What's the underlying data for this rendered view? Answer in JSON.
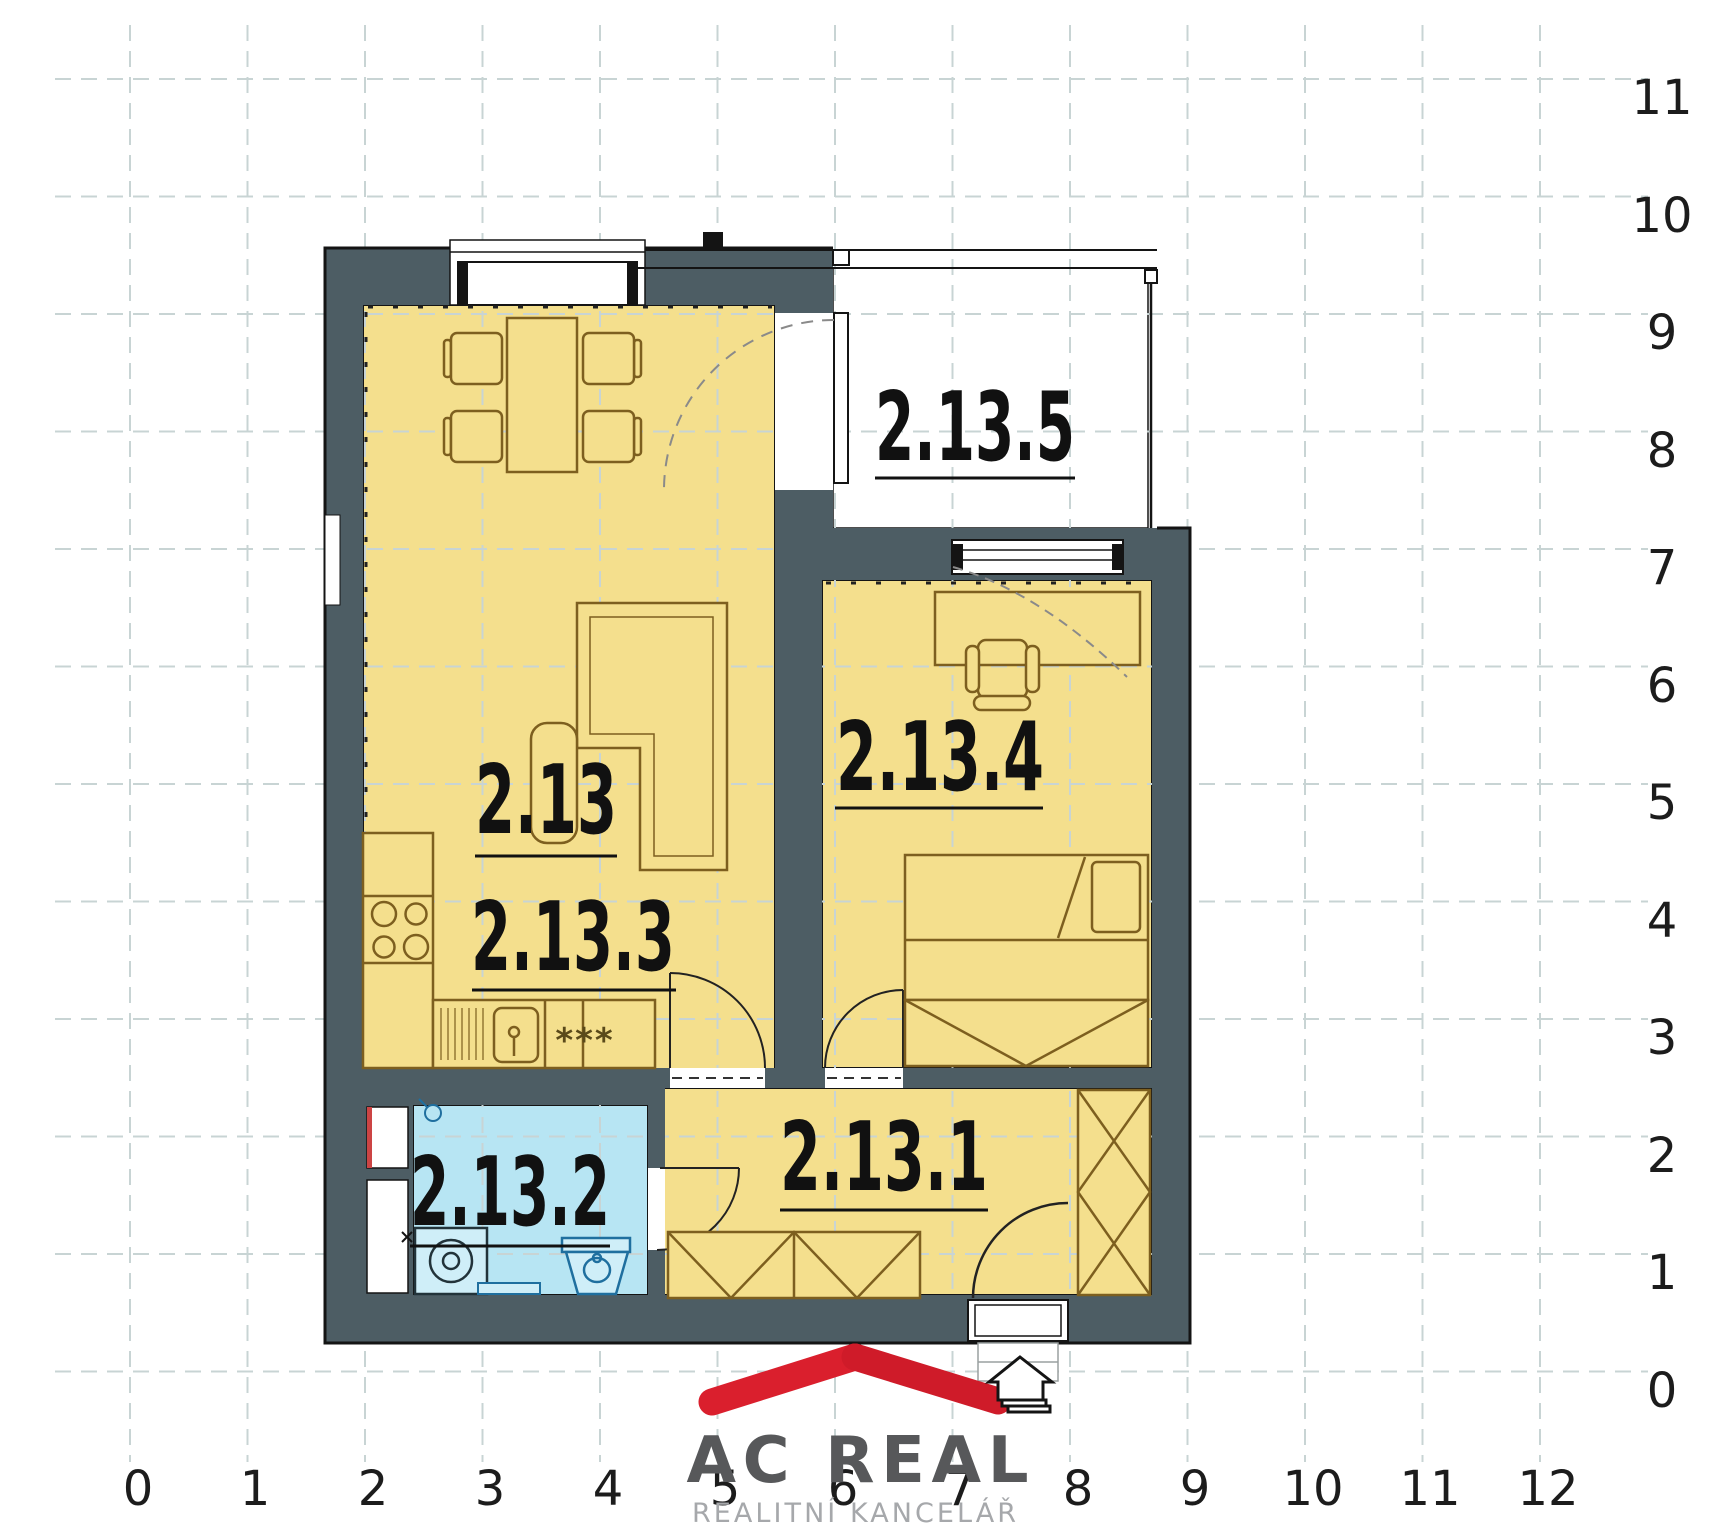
{
  "plan": {
    "rooms": [
      {
        "id": "living-room",
        "label": "2.13"
      },
      {
        "id": "kitchen-living",
        "label": "2.13.3"
      },
      {
        "id": "hallway",
        "label": "2.13.1"
      },
      {
        "id": "bathroom",
        "label": "2.13.2"
      },
      {
        "id": "bedroom",
        "label": "2.13.4"
      },
      {
        "id": "balcony",
        "label": "2.13.5"
      }
    ],
    "symbols": {
      "dishwasher": "***"
    }
  },
  "axes": {
    "bottom": [
      "0",
      "1",
      "2",
      "3",
      "4",
      "5",
      "6",
      "7",
      "8",
      "9",
      "10",
      "11",
      "12"
    ],
    "right": [
      "0",
      "1",
      "2",
      "3",
      "4",
      "5",
      "6",
      "7",
      "8",
      "9",
      "10",
      "11"
    ]
  },
  "logo": {
    "brand": "AC REAL",
    "tagline": "REALITNÍ KANCELÁŘ"
  },
  "colors": {
    "wall": "#4d5d64",
    "room_yellow": "#f4df8d",
    "bathroom_blue": "#b7e5f3",
    "furniture_tan": "#7d5f1f",
    "fixture_blue": "#1f6f9f",
    "grid": "#c8d4d4",
    "logo_red": "#da1f2d",
    "logo_gray": "#57585a",
    "logo_light_gray": "#a6a8ab"
  }
}
